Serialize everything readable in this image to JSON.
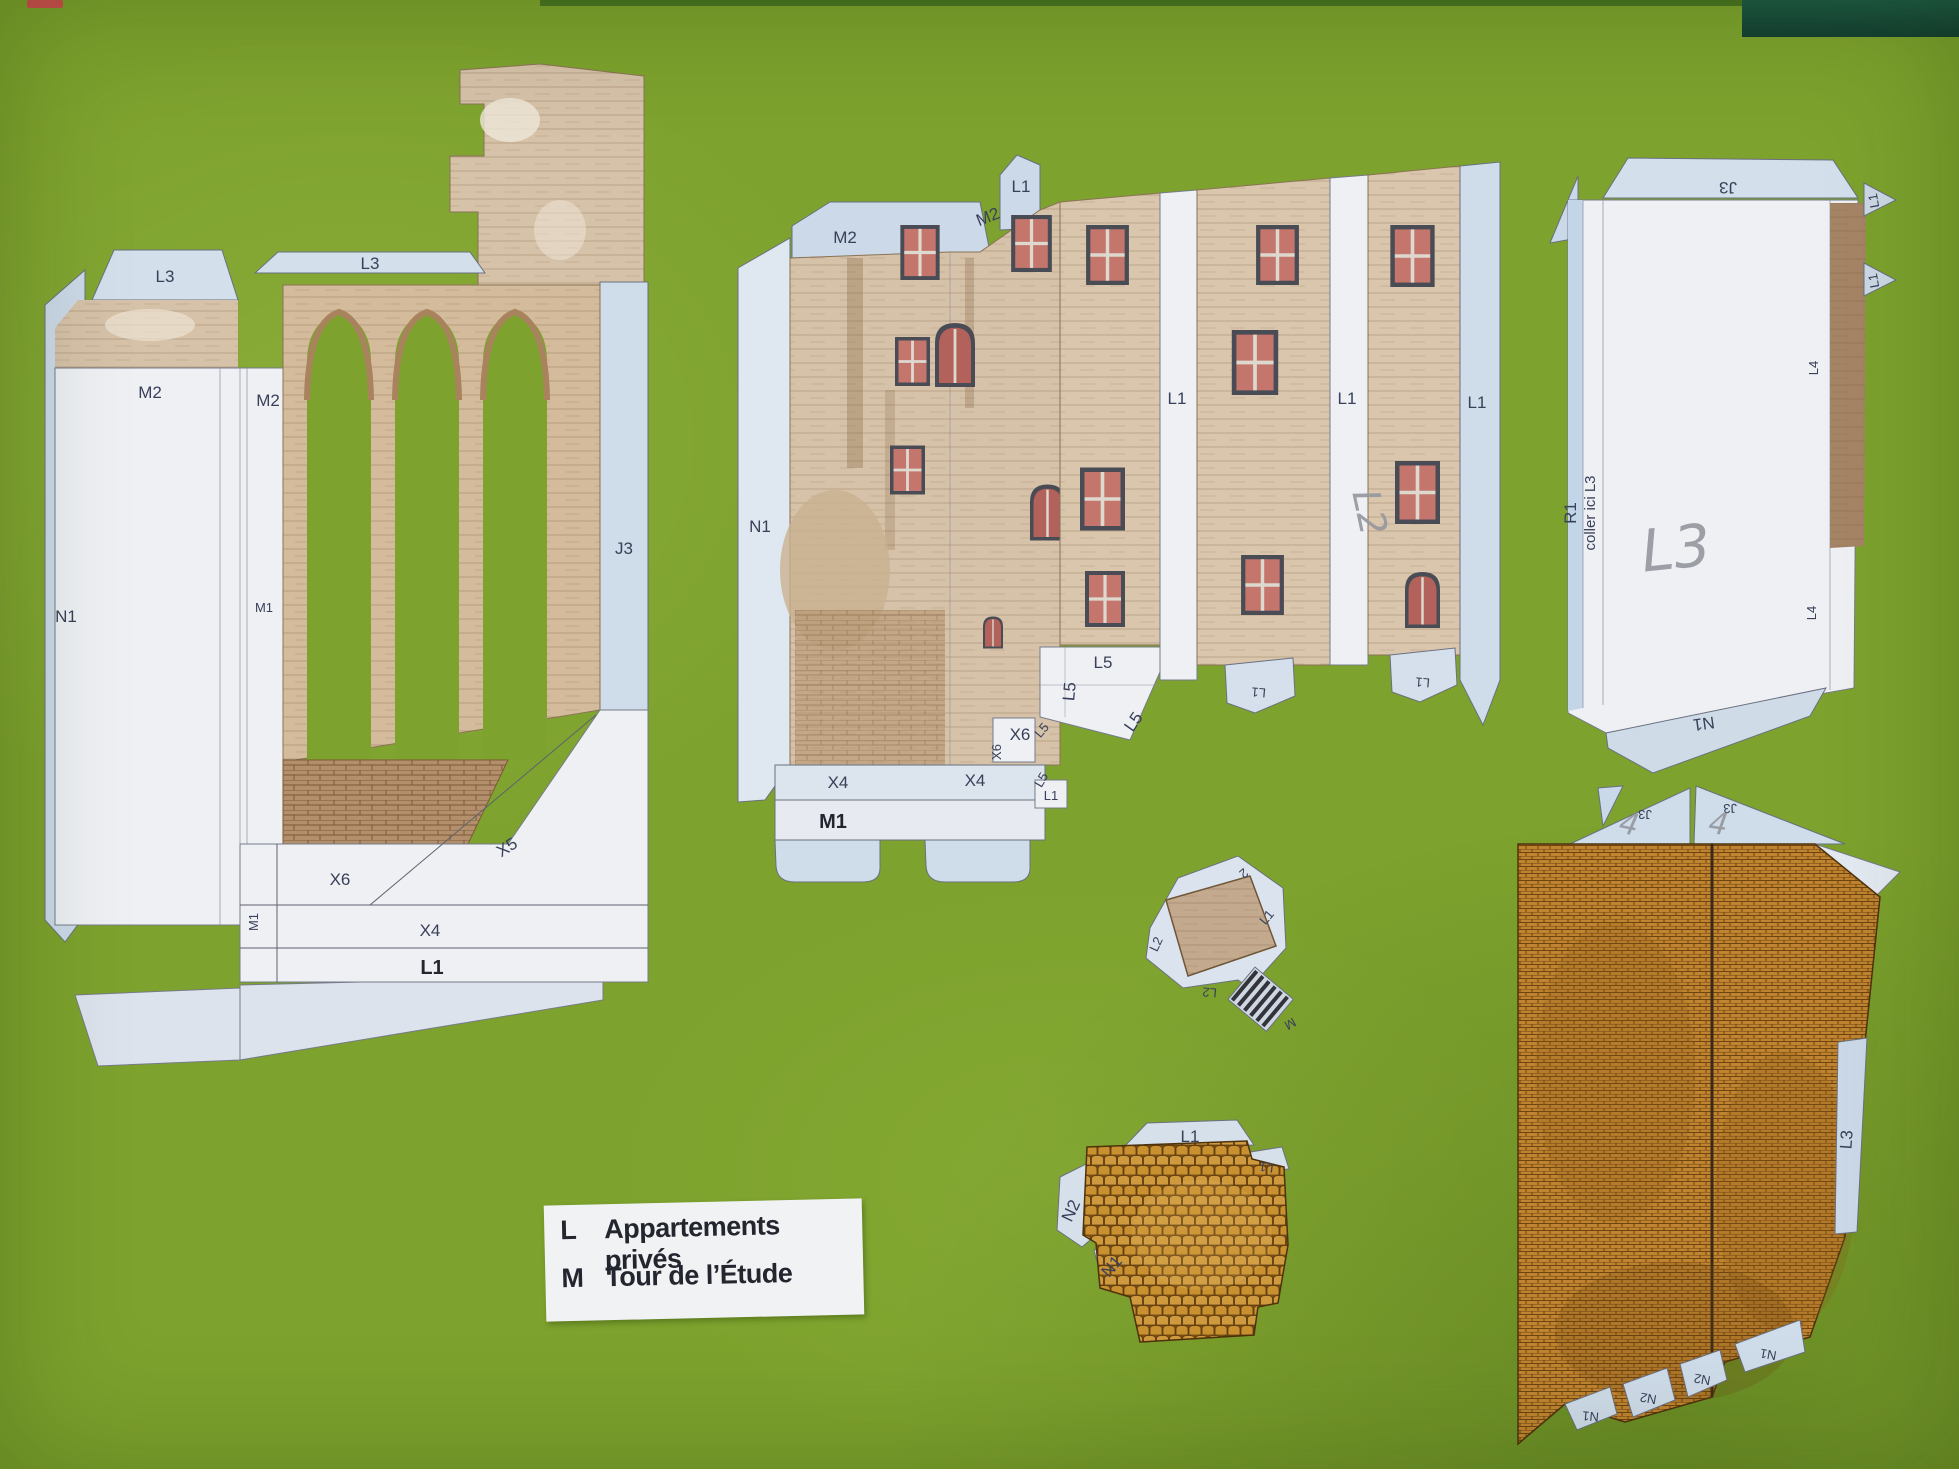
{
  "colors": {
    "mat": "#7da22d",
    "mat_edge_dark": "#1d5a45",
    "paper": "#eef0f4",
    "tab": "#ccd9e8",
    "tan": "#d6c2a8",
    "tan_dark": "#b99a78",
    "brick": "#c08430",
    "brick_mortar": "#6e4410",
    "tile": "#c8902f",
    "ink": "#39405a",
    "ink_bold": "#23262f",
    "pencil": "#95979f",
    "window": "#c4766d",
    "red_mark": "#cf4f4f"
  },
  "legend": {
    "items": [
      {
        "key": "L",
        "label": "Appartements privés"
      },
      {
        "key": "M",
        "label": "Tour de l’Étude"
      }
    ]
  },
  "pieces": {
    "aqueduct": {
      "labels": {
        "l3_left": "L3",
        "l3_right": "L3",
        "m2_left": "M2",
        "m2_right": "M2",
        "n1": "N1",
        "m1_side": "M1",
        "j3": "J3",
        "x6": "X6",
        "x5": "X5",
        "x4": "X4",
        "m1_edge": "M1",
        "l1_bold": "L1"
      }
    },
    "facade": {
      "labels": {
        "m2_tab": "M2",
        "m2_edge": "M2",
        "l1_top": "L1",
        "n1": "N1",
        "l1_sep1": "L1",
        "l1_sep2": "L1",
        "l1_sep3": "L1",
        "pencil": "L2",
        "l5_a": "L5",
        "l5_b": "L5",
        "l5_c": "L5",
        "l5_d": "L5",
        "l5_e": "L5",
        "x6_a": "X6",
        "x6_b": "X6",
        "l1_corner": "L1",
        "x4_a": "X4",
        "x4_b": "X4",
        "m1_bold": "M1",
        "l1_tab_b": "L1",
        "l1_tab_c": "L1"
      }
    },
    "side_panel": {
      "labels": {
        "j3": "J3",
        "l1_tab_a": "L1",
        "l1_tab_b": "L1",
        "r1": "R1",
        "coller": "coller ici L3",
        "pencil": "L3",
        "l4_a": "L4",
        "l4_b": "L4",
        "n1": "N1"
      }
    },
    "window_box": {
      "labels": {
        "l2_left": "L2",
        "l2_bottom": "L2",
        "l1_right": "L1",
        "l2_top": "2",
        "m": "M"
      }
    },
    "roof": {
      "labels": {
        "l1_top": "L1",
        "n2": "N2",
        "n1": "N1",
        "l1_right": "L1"
      }
    },
    "brick_wall": {
      "labels": {
        "j3_left": "J3",
        "j3_right": "J3",
        "pencil_left": "4",
        "pencil_right": "4",
        "l3": "L3",
        "n1_a": "N1",
        "n2_a": "N2",
        "n2_b": "N2",
        "n1_b": "N1"
      }
    }
  }
}
